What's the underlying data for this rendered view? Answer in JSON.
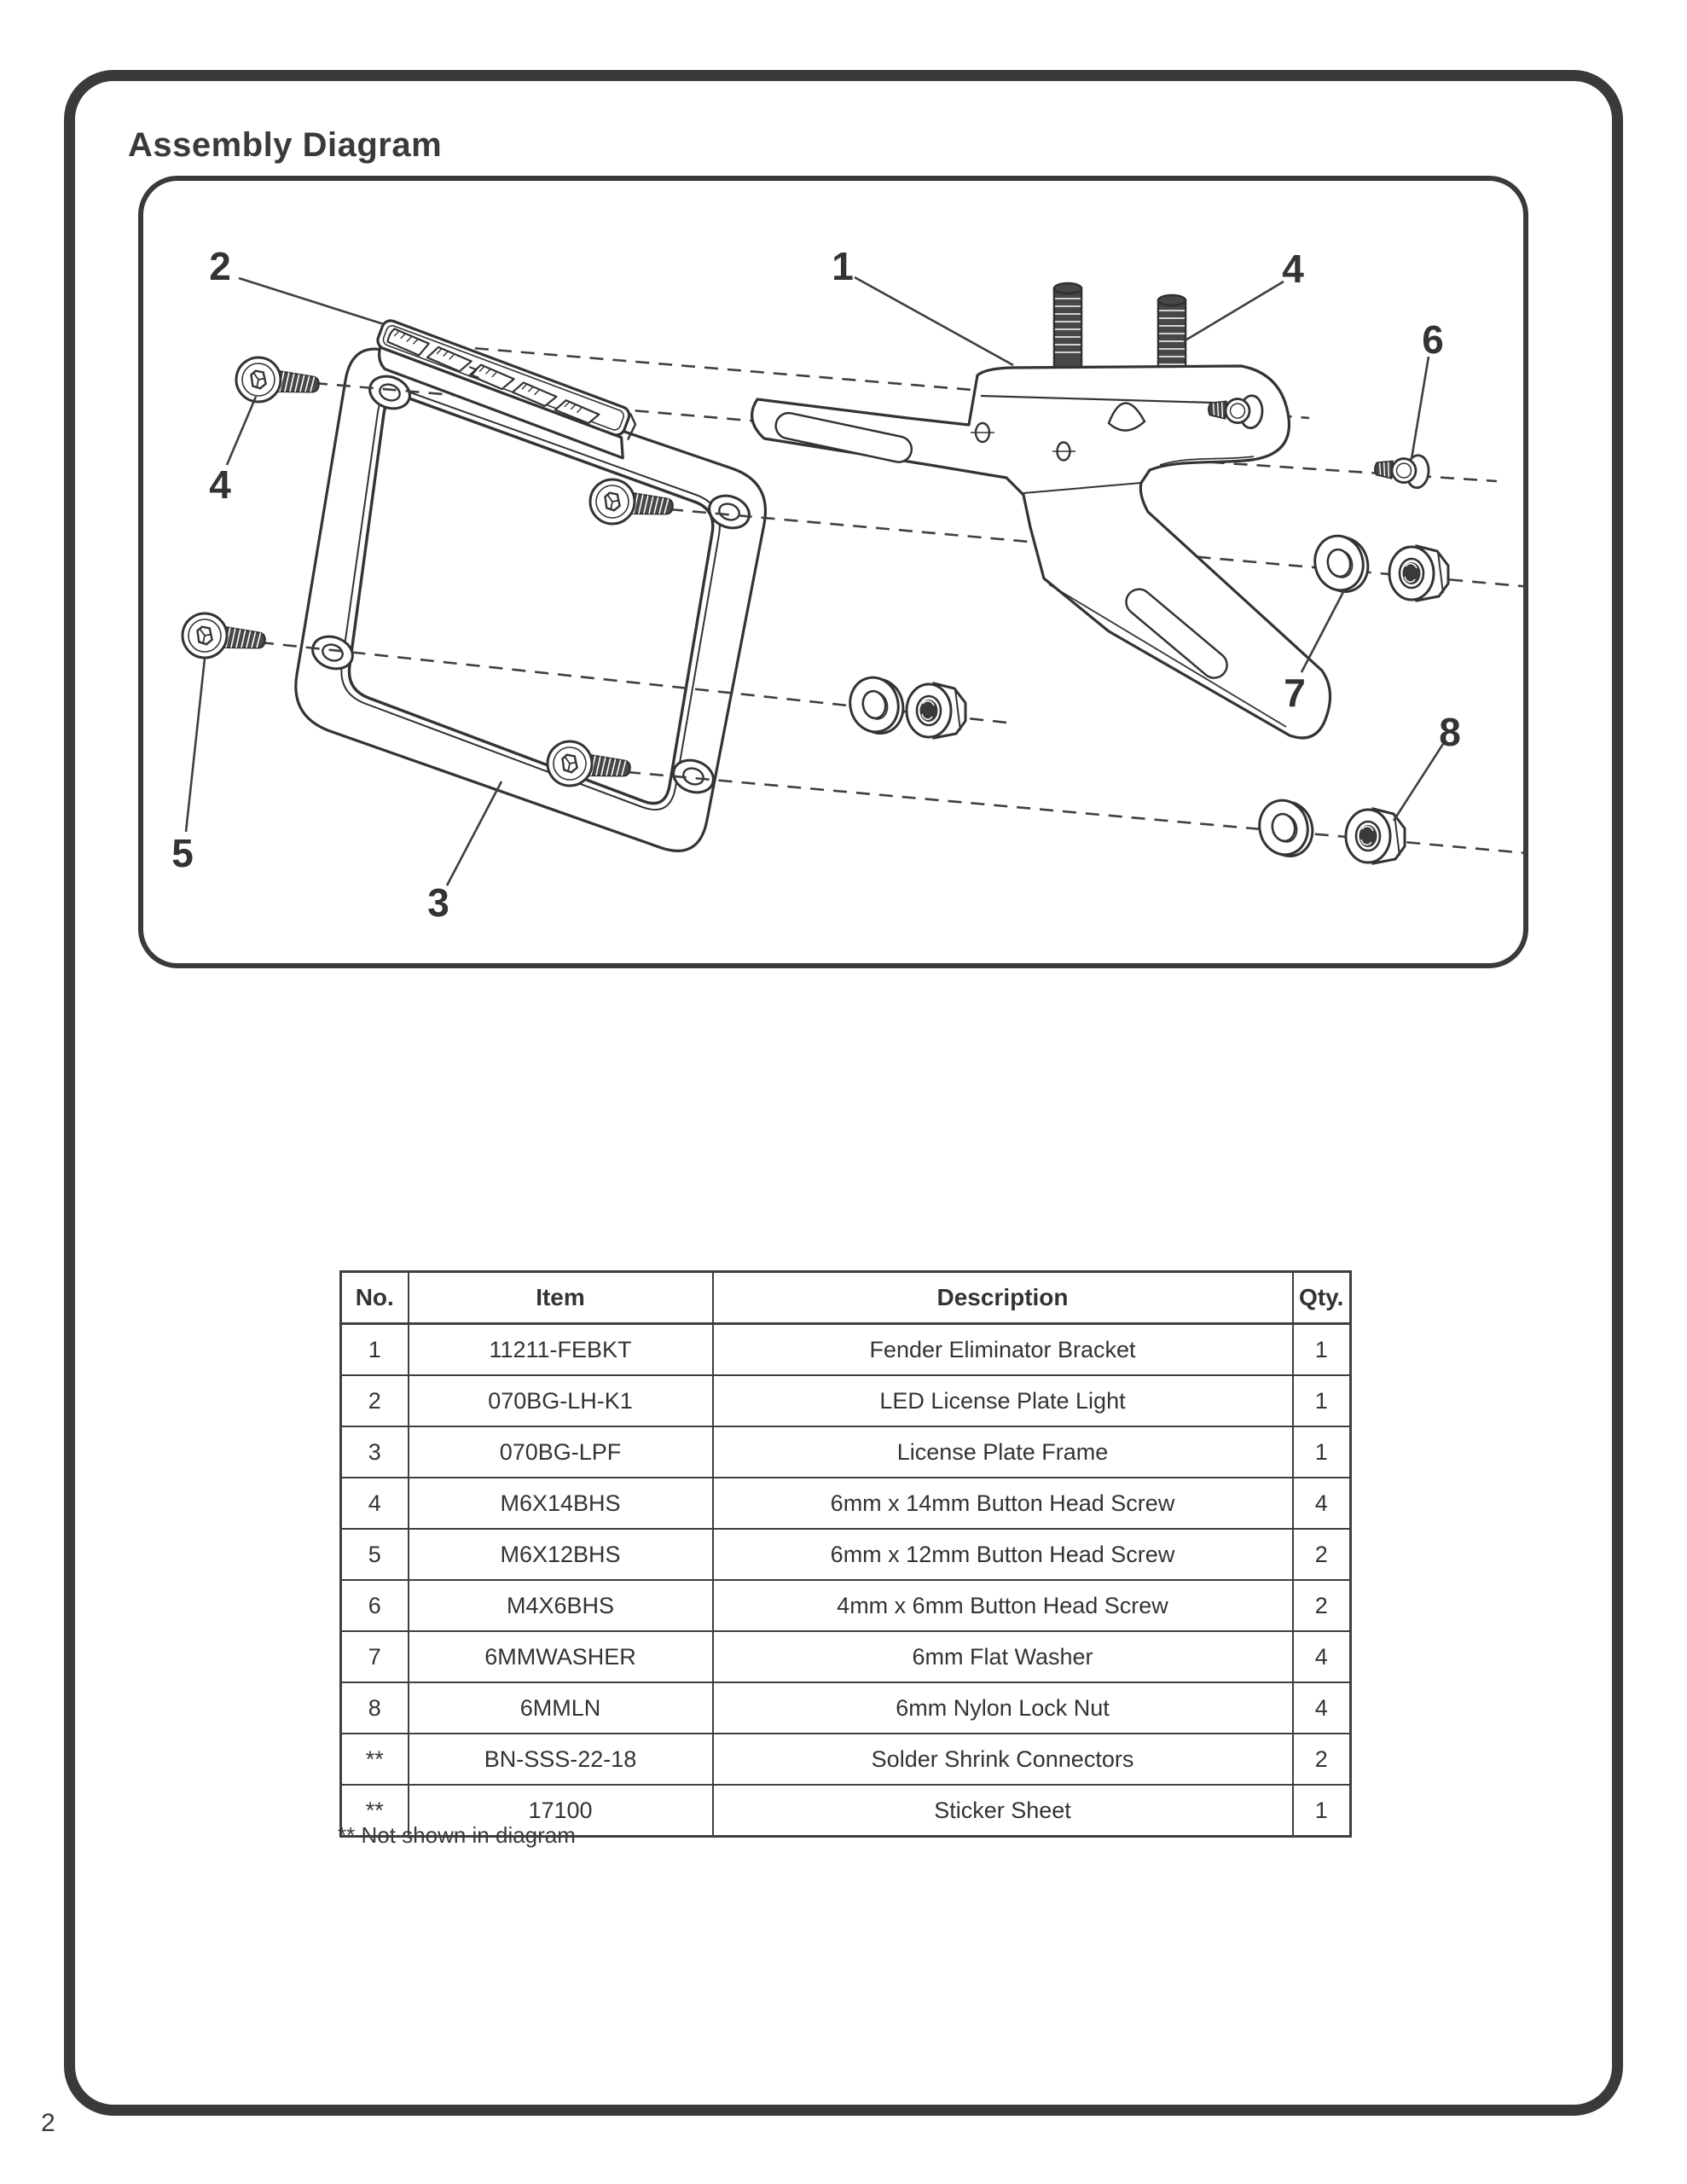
{
  "page": {
    "title": "Assembly Diagram",
    "page_number": "2"
  },
  "parts_table": {
    "headers": [
      "No.",
      "Item",
      "Description",
      "Qty."
    ],
    "rows": [
      [
        "1",
        "11211-FEBKT",
        "Fender Eliminator Bracket",
        "1"
      ],
      [
        "2",
        "070BG-LH-K1",
        "LED License Plate Light",
        "1"
      ],
      [
        "3",
        "070BG-LPF",
        "License Plate Frame",
        "1"
      ],
      [
        "4",
        "M6X14BHS",
        "6mm x 14mm Button Head Screw",
        "4"
      ],
      [
        "5",
        "M6X12BHS",
        "6mm x 12mm Button Head Screw",
        "2"
      ],
      [
        "6",
        "M4X6BHS",
        "4mm x 6mm Button Head Screw",
        "2"
      ],
      [
        "7",
        "6MMWASHER",
        "6mm Flat Washer",
        "4"
      ],
      [
        "8",
        "6MMLN",
        "6mm Nylon Lock Nut",
        "4"
      ],
      [
        "**",
        "BN-SSS-22-18",
        "Solder Shrink Connectors",
        "2"
      ],
      [
        "**",
        "17100",
        "Sticker Sheet",
        "1"
      ]
    ],
    "footnote": "** Not shown in diagram"
  },
  "diagram": {
    "callouts": {
      "c1": "1",
      "c2": "2",
      "c3": "3",
      "c4_top": "4",
      "c4_left": "4",
      "c5": "5",
      "c6": "6",
      "c7": "7",
      "c8": "8"
    }
  },
  "colors": {
    "line": "#3a3a3a",
    "text": "#333333"
  }
}
